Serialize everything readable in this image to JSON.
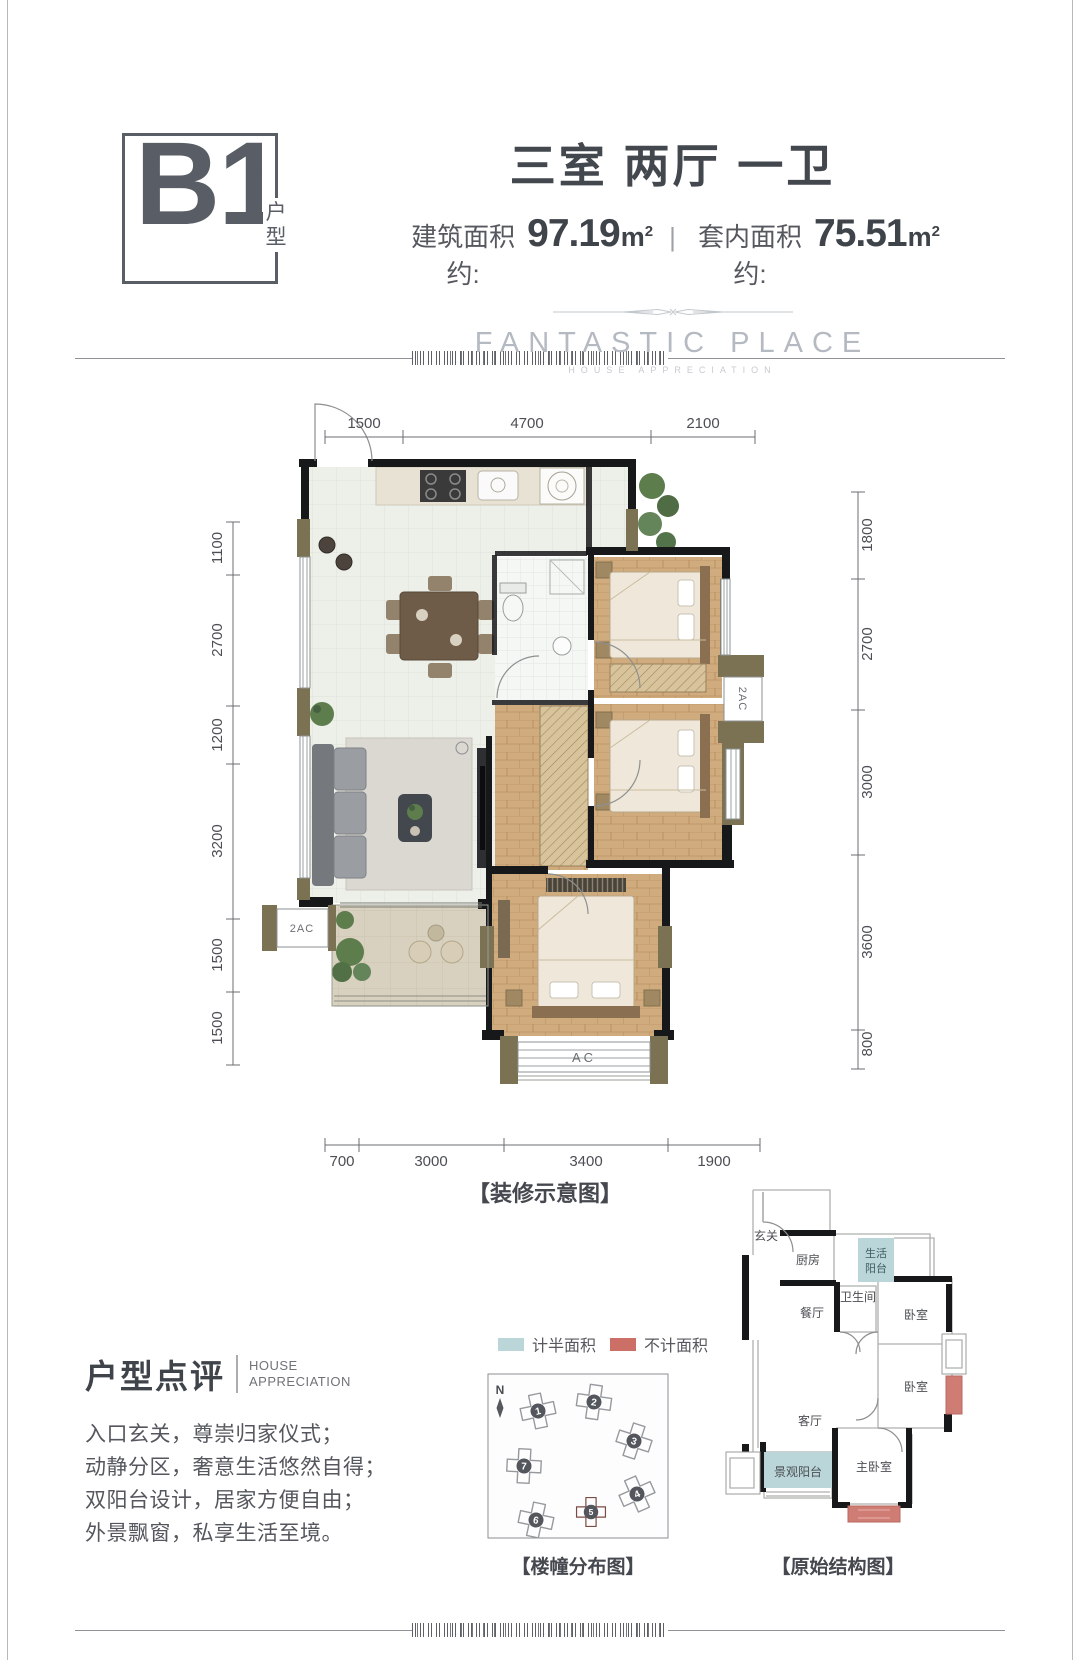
{
  "header": {
    "unit_code": "B1",
    "unit_code_label": "户型",
    "title": "三室 两厅 一卫",
    "built_area_label": "建筑面积约:",
    "built_area_value": "97.19",
    "inner_area_label": "套内面积约:",
    "inner_area_value": "75.51",
    "area_unit": "m",
    "area_unit_sup": "2",
    "divider": "|",
    "brand": "FANTASTIC PLACE",
    "brand_sub": "HOUSE APPRECIATION"
  },
  "floorplan": {
    "caption": "【装修示意图】",
    "dims_top": [
      "1500",
      "4700",
      "2100"
    ],
    "dims_left": [
      "1100",
      "2700",
      "1200",
      "3200",
      "1500",
      "1500"
    ],
    "dims_right": [
      "1800",
      "2700",
      "3000",
      "3600",
      "800"
    ],
    "dims_bottom": [
      "700",
      "3000",
      "3400",
      "1900"
    ],
    "ac_label_right": "2AC",
    "ac_label_left": "2AC",
    "ac_label_bottom": "AC"
  },
  "review": {
    "heading": "户型点评",
    "heading_en_1": "HOUSE",
    "heading_en_2": "APPRECIATION",
    "lines": [
      "入口玄关，尊崇归家仪式；",
      "动静分区，奢意生活悠然自得；",
      "双阳台设计，居家方便自由；",
      "外景飘窗，私享生活至境。"
    ]
  },
  "legend": {
    "half_label": "计半面积",
    "half_color": "#bad6d8",
    "excluded_label": "不计面积",
    "excluded_color": "#cc6f67"
  },
  "site_map": {
    "caption": "【楼幢分布图】",
    "north": "N",
    "highlight_color": "#a8453e",
    "buildings": [
      {
        "num": "1"
      },
      {
        "num": "2"
      },
      {
        "num": "3"
      },
      {
        "num": "4"
      },
      {
        "num": "5"
      },
      {
        "num": "6"
      },
      {
        "num": "7"
      }
    ]
  },
  "structure_plan": {
    "caption": "【原始结构图】",
    "rooms": {
      "entry": "玄关",
      "kitchen": "厨房",
      "life_balcony_1": "生活",
      "life_balcony_2": "阳台",
      "bath": "卫生间",
      "dining": "餐厅",
      "bedroom_a": "卧室",
      "bedroom_b": "卧室",
      "living": "客厅",
      "view_balcony": "景观阳台",
      "master": "主卧室"
    }
  }
}
